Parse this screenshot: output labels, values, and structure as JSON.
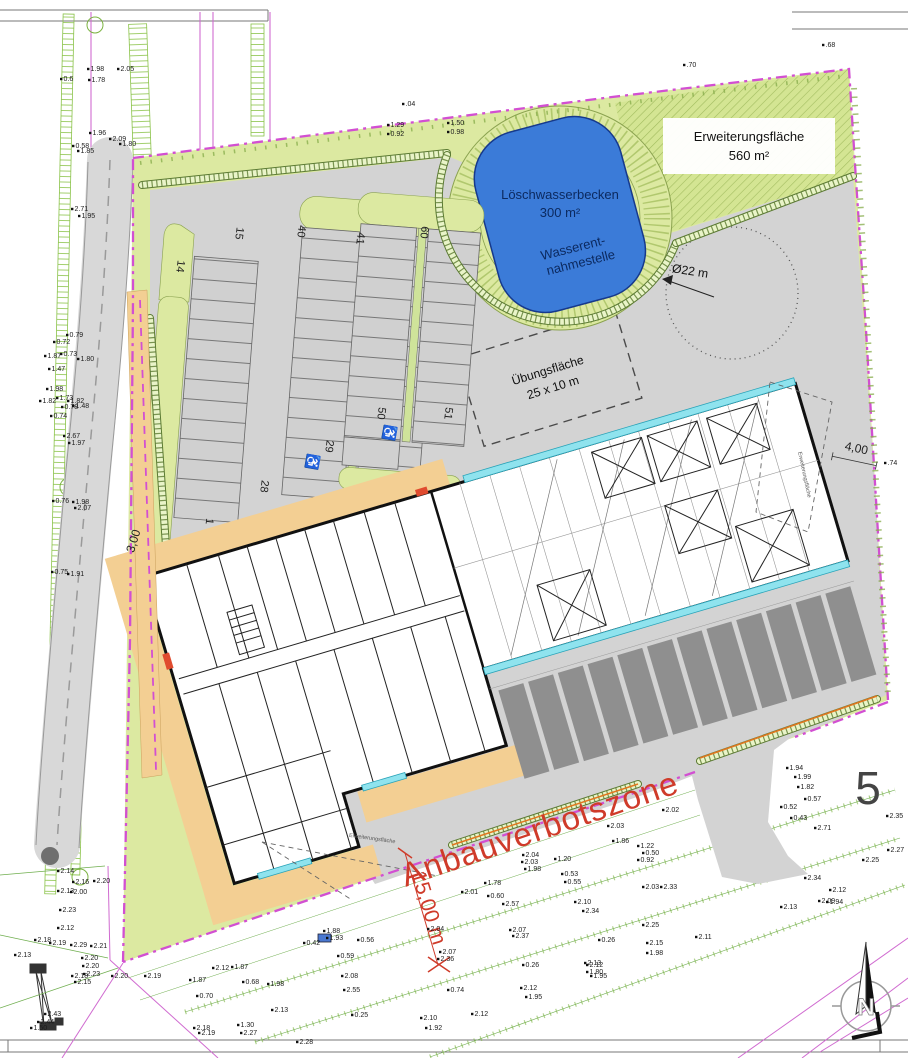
{
  "plan": {
    "areas": {
      "expansion": {
        "name": "Erweiterungsfläche",
        "size": "560 m²"
      },
      "fire_water_basin": {
        "name": "Löschwasserbecken",
        "size": "300 m²"
      },
      "water_extraction": {
        "line1": "Wasserent-",
        "line2": "nahmestelle"
      },
      "training_area": {
        "name": "Übungsfläche",
        "size": "25 x 10 m"
      },
      "small_area_label": "Erweiterungsfläche"
    },
    "dimensions": {
      "turning_circle": "Ø22 m",
      "offset_west": "3,00",
      "offset_east": "4,00",
      "zone_width": "15,00 m"
    },
    "zone_label": "Anbauverbotszone",
    "parcel_number": "5",
    "north_letter": "N",
    "accessible_icon": "♿",
    "parking_numbers": [
      {
        "v": "14",
        "x": 177,
        "y": 266,
        "r": 97
      },
      {
        "v": "15",
        "x": 236,
        "y": 233,
        "r": 97
      },
      {
        "v": "40",
        "x": 298,
        "y": 231,
        "r": 97
      },
      {
        "v": "41",
        "x": 357,
        "y": 238,
        "r": 97
      },
      {
        "v": "60",
        "x": 421,
        "y": 232,
        "r": 97
      },
      {
        "v": "1",
        "x": 206,
        "y": 521,
        "r": 97
      },
      {
        "v": "28",
        "x": 261,
        "y": 486,
        "r": 97
      },
      {
        "v": "29",
        "x": 326,
        "y": 446,
        "r": 97
      },
      {
        "v": "50",
        "x": 378,
        "y": 413,
        "r": 97
      },
      {
        "v": "51",
        "x": 445,
        "y": 413,
        "r": 97
      }
    ],
    "survey_points": [
      {
        "x": 123,
        "y": 71,
        "v": "2.05"
      },
      {
        "x": 93,
        "y": 71,
        "v": "1.98"
      },
      {
        "x": 94,
        "y": 82,
        "v": "1.78"
      },
      {
        "x": 66,
        "y": 81,
        "v": "0.6"
      },
      {
        "x": 115,
        "y": 141,
        "v": "2.09"
      },
      {
        "x": 95,
        "y": 135,
        "v": "1.96"
      },
      {
        "x": 125,
        "y": 146,
        "v": "1.80"
      },
      {
        "x": 78,
        "y": 148,
        "v": "0.58"
      },
      {
        "x": 83,
        "y": 153,
        "v": "1.85"
      },
      {
        "x": 77,
        "y": 211,
        "v": "2.71"
      },
      {
        "x": 84,
        "y": 218,
        "v": "1.95"
      },
      {
        "x": 72,
        "y": 337,
        "v": "0.79"
      },
      {
        "x": 59,
        "y": 344,
        "v": "0.72"
      },
      {
        "x": 66,
        "y": 356,
        "v": "0.73"
      },
      {
        "x": 83,
        "y": 361,
        "v": "1.80"
      },
      {
        "x": 50,
        "y": 358,
        "v": "1.87"
      },
      {
        "x": 54,
        "y": 371,
        "v": "1.47"
      },
      {
        "x": 52,
        "y": 391,
        "v": "1.98"
      },
      {
        "x": 45,
        "y": 403,
        "v": "1.82"
      },
      {
        "x": 62,
        "y": 400,
        "v": "1.73"
      },
      {
        "x": 73,
        "y": 403,
        "v": "1.82"
      },
      {
        "x": 67,
        "y": 409,
        "v": "0.78"
      },
      {
        "x": 78,
        "y": 408,
        "v": "1.48"
      },
      {
        "x": 56,
        "y": 418,
        "v": "0.74"
      },
      {
        "x": 69,
        "y": 438,
        "v": "2.67"
      },
      {
        "x": 74,
        "y": 445,
        "v": "1.97"
      },
      {
        "x": 58,
        "y": 503,
        "v": "0.76"
      },
      {
        "x": 78,
        "y": 504,
        "v": "1.98"
      },
      {
        "x": 80,
        "y": 510,
        "v": "2.07"
      },
      {
        "x": 57,
        "y": 574,
        "v": "0.75"
      },
      {
        "x": 73,
        "y": 576,
        "v": "1.91"
      },
      {
        "x": 689,
        "y": 67,
        "v": ".70"
      },
      {
        "x": 828,
        "y": 47,
        "v": ".68"
      },
      {
        "x": 408,
        "y": 106,
        "v": ".04"
      },
      {
        "x": 393,
        "y": 127,
        "v": "1.29"
      },
      {
        "x": 393,
        "y": 136,
        "v": "0.92"
      },
      {
        "x": 453,
        "y": 125,
        "v": "1.50"
      },
      {
        "x": 453,
        "y": 134,
        "v": "0.98"
      },
      {
        "x": 890,
        "y": 465,
        "v": ".74"
      },
      {
        "x": 668,
        "y": 812,
        "v": "2.02"
      },
      {
        "x": 613,
        "y": 828,
        "v": "2.03"
      },
      {
        "x": 618,
        "y": 843,
        "v": "1.86"
      },
      {
        "x": 643,
        "y": 848,
        "v": "1.22"
      },
      {
        "x": 648,
        "y": 855,
        "v": "0.50"
      },
      {
        "x": 643,
        "y": 862,
        "v": "0.92"
      },
      {
        "x": 528,
        "y": 857,
        "v": "2.04"
      },
      {
        "x": 527,
        "y": 864,
        "v": "2.03"
      },
      {
        "x": 530,
        "y": 871,
        "v": "1.98"
      },
      {
        "x": 560,
        "y": 861,
        "v": "1.20"
      },
      {
        "x": 567,
        "y": 876,
        "v": "0.53"
      },
      {
        "x": 570,
        "y": 884,
        "v": "0.55"
      },
      {
        "x": 490,
        "y": 885,
        "v": "1.78"
      },
      {
        "x": 467,
        "y": 894,
        "v": "2.01"
      },
      {
        "x": 493,
        "y": 898,
        "v": "0.60"
      },
      {
        "x": 508,
        "y": 906,
        "v": "2.57"
      },
      {
        "x": 648,
        "y": 889,
        "v": "2.03"
      },
      {
        "x": 666,
        "y": 889,
        "v": "2.33"
      },
      {
        "x": 580,
        "y": 904,
        "v": "2.10"
      },
      {
        "x": 588,
        "y": 913,
        "v": "2.34"
      },
      {
        "x": 648,
        "y": 927,
        "v": "2.25"
      },
      {
        "x": 604,
        "y": 942,
        "v": "0.26"
      },
      {
        "x": 652,
        "y": 945,
        "v": "2.15"
      },
      {
        "x": 652,
        "y": 955,
        "v": "1.98"
      },
      {
        "x": 515,
        "y": 932,
        "v": "2.07"
      },
      {
        "x": 518,
        "y": 938,
        "v": "2.37"
      },
      {
        "x": 528,
        "y": 967,
        "v": "0.26"
      },
      {
        "x": 590,
        "y": 965,
        "v": "2.13"
      },
      {
        "x": 592,
        "y": 974,
        "v": "1.80"
      },
      {
        "x": 433,
        "y": 931,
        "v": "2.04"
      },
      {
        "x": 445,
        "y": 954,
        "v": "2.07"
      },
      {
        "x": 443,
        "y": 961,
        "v": "2.36"
      },
      {
        "x": 453,
        "y": 992,
        "v": "0.74"
      },
      {
        "x": 477,
        "y": 1016,
        "v": "2.12"
      },
      {
        "x": 426,
        "y": 1020,
        "v": "2.10"
      },
      {
        "x": 431,
        "y": 1030,
        "v": "1.92"
      },
      {
        "x": 357,
        "y": 1017,
        "v": "0.25"
      },
      {
        "x": 302,
        "y": 1044,
        "v": "2.28"
      },
      {
        "x": 332,
        "y": 940,
        "v": "1.93"
      },
      {
        "x": 329,
        "y": 933,
        "v": "1.88"
      },
      {
        "x": 363,
        "y": 942,
        "v": "0.56"
      },
      {
        "x": 309,
        "y": 945,
        "v": "0.42"
      },
      {
        "x": 343,
        "y": 958,
        "v": "0.59"
      },
      {
        "x": 347,
        "y": 978,
        "v": "2.08"
      },
      {
        "x": 349,
        "y": 992,
        "v": "2.55"
      },
      {
        "x": 526,
        "y": 990,
        "v": "2.12"
      },
      {
        "x": 531,
        "y": 999,
        "v": "1.95"
      },
      {
        "x": 592,
        "y": 967,
        "v": "2.12"
      },
      {
        "x": 596,
        "y": 978,
        "v": "1.95"
      },
      {
        "x": 701,
        "y": 939,
        "v": "2.11"
      },
      {
        "x": 792,
        "y": 770,
        "v": "1.94"
      },
      {
        "x": 800,
        "y": 779,
        "v": "1.99"
      },
      {
        "x": 803,
        "y": 789,
        "v": "1.82"
      },
      {
        "x": 810,
        "y": 801,
        "v": "0.57"
      },
      {
        "x": 786,
        "y": 809,
        "v": "0.52"
      },
      {
        "x": 796,
        "y": 820,
        "v": "0.43"
      },
      {
        "x": 820,
        "y": 830,
        "v": "2.71"
      },
      {
        "x": 892,
        "y": 818,
        "v": "2.35"
      },
      {
        "x": 893,
        "y": 852,
        "v": "2.27"
      },
      {
        "x": 868,
        "y": 862,
        "v": "2.25"
      },
      {
        "x": 810,
        "y": 880,
        "v": "2.34"
      },
      {
        "x": 835,
        "y": 892,
        "v": "2.12"
      },
      {
        "x": 824,
        "y": 903,
        "v": "2.09"
      },
      {
        "x": 832,
        "y": 904,
        "v": "1.94"
      },
      {
        "x": 786,
        "y": 909,
        "v": "2.13"
      },
      {
        "x": 63,
        "y": 873,
        "v": "2.14"
      },
      {
        "x": 78,
        "y": 884,
        "v": "2.16"
      },
      {
        "x": 99,
        "y": 883,
        "v": "2.20"
      },
      {
        "x": 63,
        "y": 893,
        "v": "2.13"
      },
      {
        "x": 76,
        "y": 894,
        "v": "2.00"
      },
      {
        "x": 65,
        "y": 912,
        "v": "2.23"
      },
      {
        "x": 63,
        "y": 930,
        "v": "2.12"
      },
      {
        "x": 40,
        "y": 942,
        "v": "2.18"
      },
      {
        "x": 55,
        "y": 945,
        "v": "2.19"
      },
      {
        "x": 76,
        "y": 947,
        "v": "2.29"
      },
      {
        "x": 20,
        "y": 957,
        "v": "2.13"
      },
      {
        "x": 96,
        "y": 948,
        "v": "2.21"
      },
      {
        "x": 87,
        "y": 960,
        "v": "2.20"
      },
      {
        "x": 88,
        "y": 968,
        "v": "2.20"
      },
      {
        "x": 77,
        "y": 978,
        "v": "2.18"
      },
      {
        "x": 80,
        "y": 984,
        "v": "2.15"
      },
      {
        "x": 89,
        "y": 976,
        "v": "2.23"
      },
      {
        "x": 117,
        "y": 978,
        "v": "2.20"
      },
      {
        "x": 150,
        "y": 978,
        "v": "2.19"
      },
      {
        "x": 195,
        "y": 982,
        "v": "1.87"
      },
      {
        "x": 218,
        "y": 970,
        "v": "2.12"
      },
      {
        "x": 237,
        "y": 969,
        "v": "1.87"
      },
      {
        "x": 248,
        "y": 984,
        "v": "0.68"
      },
      {
        "x": 273,
        "y": 986,
        "v": "1.98"
      },
      {
        "x": 202,
        "y": 998,
        "v": "0.70"
      },
      {
        "x": 277,
        "y": 1012,
        "v": "2.13"
      },
      {
        "x": 199,
        "y": 1030,
        "v": "2.18"
      },
      {
        "x": 204,
        "y": 1035,
        "v": "2.19"
      },
      {
        "x": 243,
        "y": 1027,
        "v": "1.30"
      },
      {
        "x": 246,
        "y": 1035,
        "v": "2.27"
      },
      {
        "x": 43,
        "y": 1024,
        "v": "2.44"
      },
      {
        "x": 36,
        "y": 1030,
        "v": "1.50"
      },
      {
        "x": 50,
        "y": 1016,
        "v": "2.43"
      }
    ],
    "colors": {
      "boundary_magenta": "#d24fd2",
      "site_green": "#dce9a1",
      "pavement_gray": "#d3d3d3",
      "stall_dark_gray": "#8f8f8f",
      "water_blue": "#3b7bd8",
      "alert_red": "#cf3b2a",
      "window_cyan": "#8fe3ee",
      "path_orange": "#f3cf93"
    }
  }
}
